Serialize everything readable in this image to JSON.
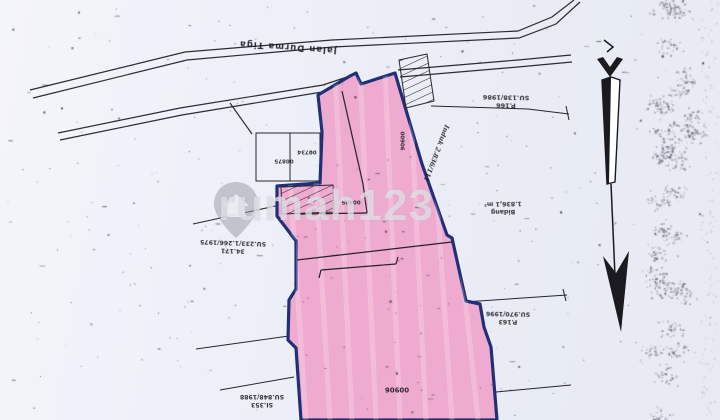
{
  "watermark": {
    "text": "rumah123",
    "icon": "map-pin-house"
  },
  "road": {
    "name": "Jalan Durma Tiga"
  },
  "compass": {
    "icon": "north-arrow",
    "points": "down"
  },
  "parcels": {
    "p166": {
      "id": "P.166",
      "ref": "SU.138/1986"
    },
    "k34171": {
      "id": "34.171",
      "ref": "SU.233/1.266/1975"
    },
    "bidang": {
      "id": "Bidang",
      "ref": "1.836,1 m²"
    },
    "p163": {
      "id": "P.163",
      "ref": "SU.970/1996"
    },
    "si353": {
      "id": "SI.353",
      "ref": "SU.848/1988"
    }
  },
  "nib": {
    "a": "00875",
    "b": "00734",
    "c": "00405",
    "strip": "00906",
    "main": "00906"
  },
  "annotations": {
    "survey_note": "Induk 2.836/111"
  },
  "colors": {
    "paper": "#edeff7",
    "parcel_fill": "#efaacf",
    "parcel_border": "#203078",
    "ink": "#1c1c24",
    "watermark": "#dcdce3"
  }
}
